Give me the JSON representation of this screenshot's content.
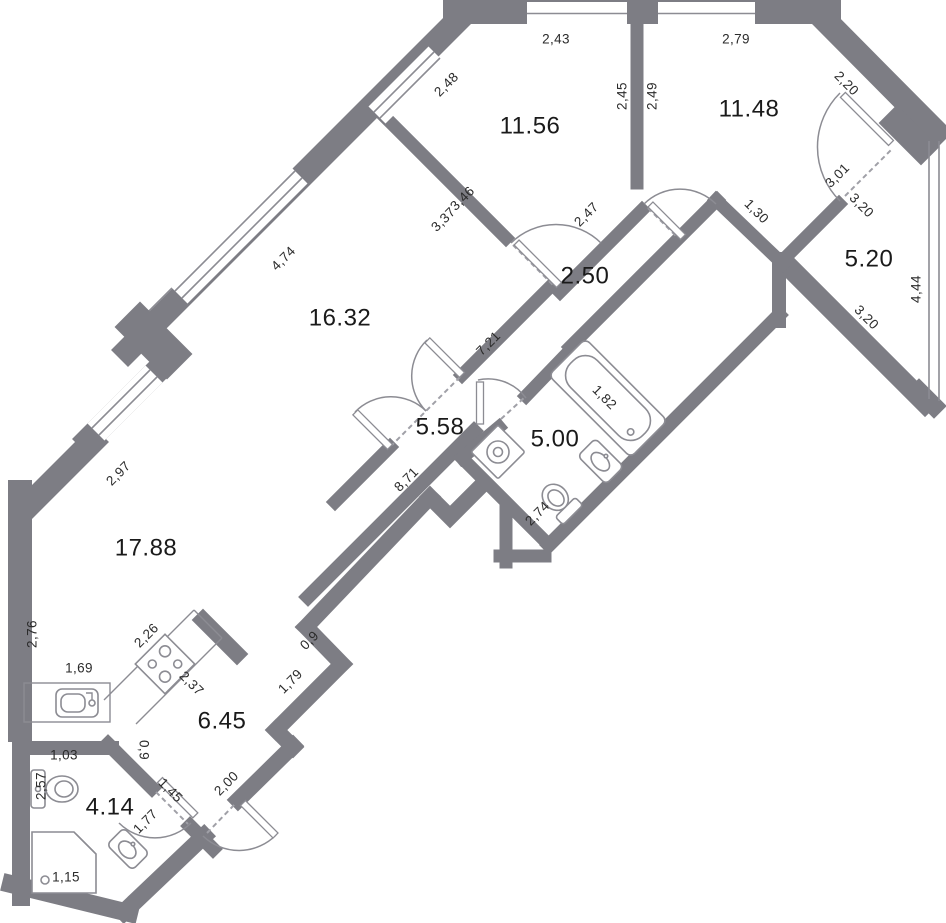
{
  "plan_title": "Apartment floor plan",
  "colors": {
    "wall": "#7d7d84",
    "fixture_line": "#8c8c93",
    "dimension_text": "#2b2b2b",
    "area_text": "#1a1a1a",
    "background": "#ffffff"
  },
  "rooms": [
    {
      "name": "bedroom-1",
      "area": "11.56"
    },
    {
      "name": "bedroom-2",
      "area": "11.48"
    },
    {
      "name": "loggia",
      "area": "5.20"
    },
    {
      "name": "hall-upper",
      "area": "2.50"
    },
    {
      "name": "living-room",
      "area": "16.32"
    },
    {
      "name": "corridor-middle",
      "area": "5.58"
    },
    {
      "name": "bathroom",
      "area": "5.00"
    },
    {
      "name": "kitchen-living-room",
      "area": "17.88"
    },
    {
      "name": "entry-hall",
      "area": "6.45"
    },
    {
      "name": "wc",
      "area": "4.14"
    }
  ],
  "dims": [
    {
      "value": "2,43"
    },
    {
      "value": "2,79"
    },
    {
      "value": "2,48"
    },
    {
      "value": "2,20"
    },
    {
      "value": "2,45"
    },
    {
      "value": "2,49"
    },
    {
      "value": "3,46"
    },
    {
      "value": "3,37"
    },
    {
      "value": "2,47"
    },
    {
      "value": "1,30"
    },
    {
      "value": "3,01"
    },
    {
      "value": "3,20"
    },
    {
      "value": "3,20"
    },
    {
      "value": "4,44"
    },
    {
      "value": "4,74"
    },
    {
      "value": "7,21"
    },
    {
      "value": "1,82"
    },
    {
      "value": "2,74"
    },
    {
      "value": "8,71"
    },
    {
      "value": "2,97"
    },
    {
      "value": "2,76"
    },
    {
      "value": "2,26"
    },
    {
      "value": "1,69"
    },
    {
      "value": "2,37"
    },
    {
      "value": "0,9"
    },
    {
      "value": "1,79"
    },
    {
      "value": "0,9"
    },
    {
      "value": "2,00"
    },
    {
      "value": "1,45"
    },
    {
      "value": "1,77"
    },
    {
      "value": "1,03"
    },
    {
      "value": "2,57"
    },
    {
      "value": "1,15"
    }
  ],
  "fixtures": [
    "bathtub-icon",
    "washing-machine-icon",
    "toilet-icon",
    "sink-icon",
    "toilet-icon",
    "shower-icon",
    "sink-icon",
    "stove-icon",
    "kitchen-sink-icon"
  ]
}
